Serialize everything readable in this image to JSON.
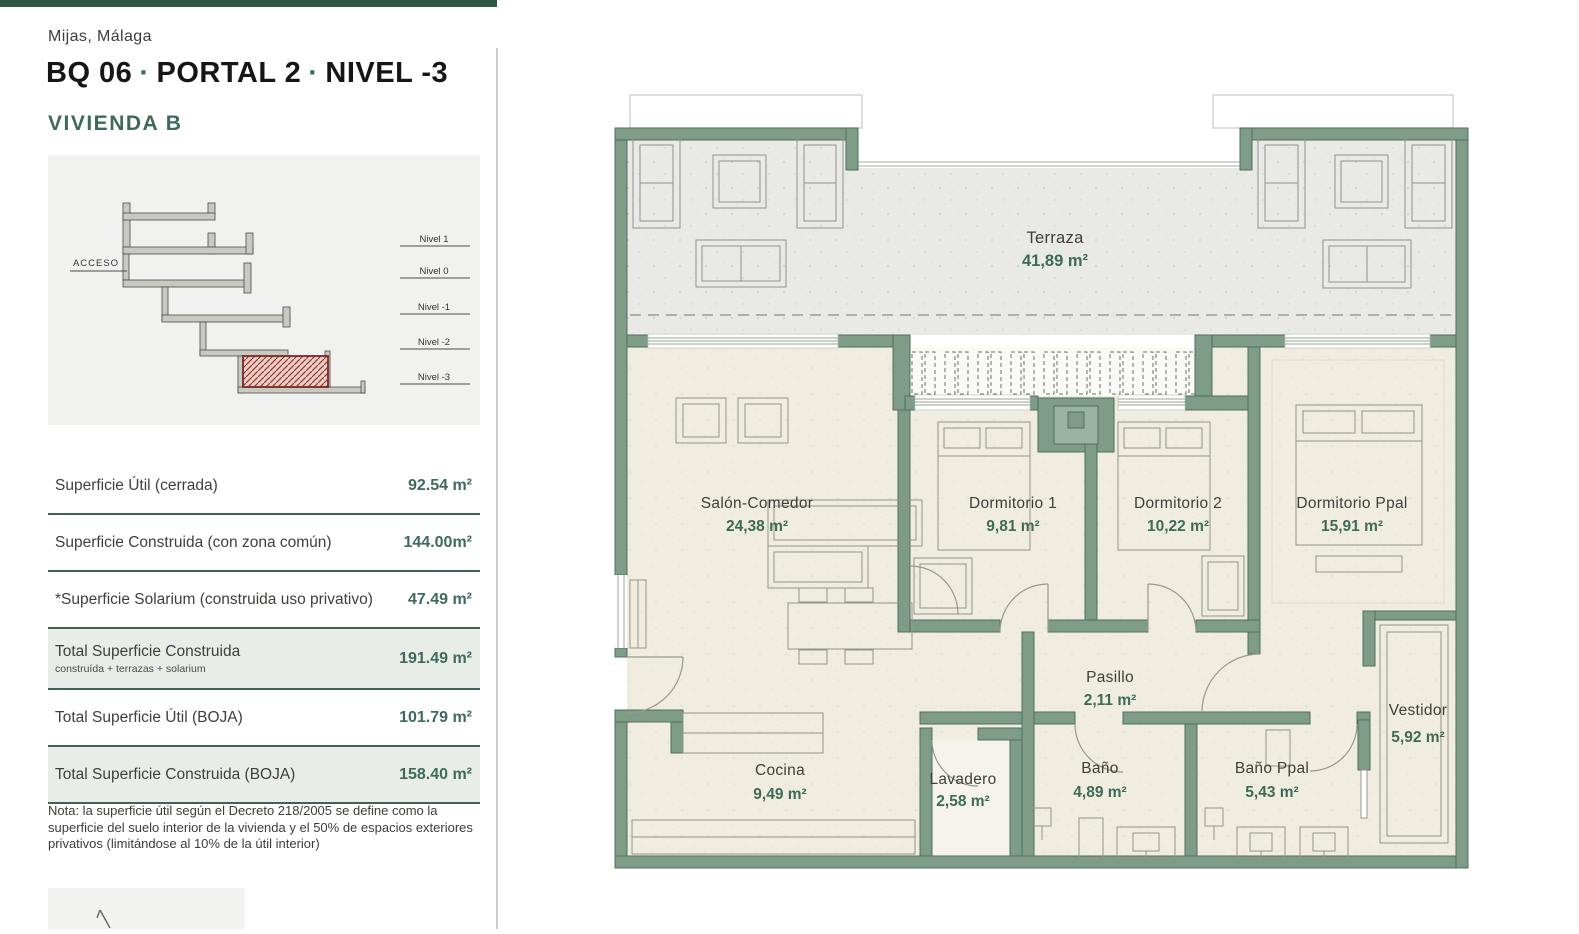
{
  "colors": {
    "accent_green": "#3D6B57",
    "wall_green": "#7E9C88",
    "band_green": "#E9EDE9",
    "top_bar_green": "#2E5846",
    "hatch_red": "#A03328"
  },
  "header": {
    "location": "Mijas, Málaga",
    "title_parts": [
      "BQ 06",
      "PORTAL 2",
      "NIVEL -3"
    ],
    "dot": "·",
    "unit": "VIVIENDA B"
  },
  "section_diagram": {
    "access_label": "ACCESO",
    "levels": [
      "Nivel 1",
      "Nivel 0",
      "Nivel -1",
      "Nivel -2",
      "Nivel -3"
    ]
  },
  "areas": {
    "rows": [
      {
        "label": "Superficie Útil (cerrada)",
        "value": "92.54 m²"
      },
      {
        "label": "Superficie Construida (con zona común)",
        "value": "144.00m²"
      },
      {
        "label": "*Superficie Solarium (construida uso privativo)",
        "value": "47.49 m²"
      },
      {
        "label": "Total Superficie Construida",
        "sublabel": "construída + terrazas + solarium",
        "value": "191.49 m²"
      },
      {
        "label": "Total Superficie Útil (BOJA)",
        "value": "101.79 m²"
      },
      {
        "label": "Total Superficie Construida (BOJA)",
        "value": "158.40 m²"
      }
    ]
  },
  "note": "Nota: la superficie útil según el Decreto 218/2005 se define como la superficie del suelo interior de la vivienda y el 50% de espacios exteriores privativos (limitándose al 10% de la útil interior)",
  "plan": {
    "rooms": [
      {
        "name": "Terraza",
        "area": "41,89 m²"
      },
      {
        "name": "Salón-Comedor",
        "area": "24,38 m²"
      },
      {
        "name": "Dormitorio 1",
        "area": "9,81 m²"
      },
      {
        "name": "Dormitorio 2",
        "area": "10,22 m²"
      },
      {
        "name": "Dormitorio Ppal",
        "area": "15,91 m²"
      },
      {
        "name": "Pasillo",
        "area": "2,11 m²"
      },
      {
        "name": "Cocina",
        "area": "9,49 m²"
      },
      {
        "name": "Lavadero",
        "area": "2,58 m²"
      },
      {
        "name": "Baño",
        "area": "4,89 m²"
      },
      {
        "name": "Baño Ppal",
        "area": "5,43 m²"
      },
      {
        "name": "Vestidor",
        "area": "5,92 m²"
      }
    ]
  }
}
